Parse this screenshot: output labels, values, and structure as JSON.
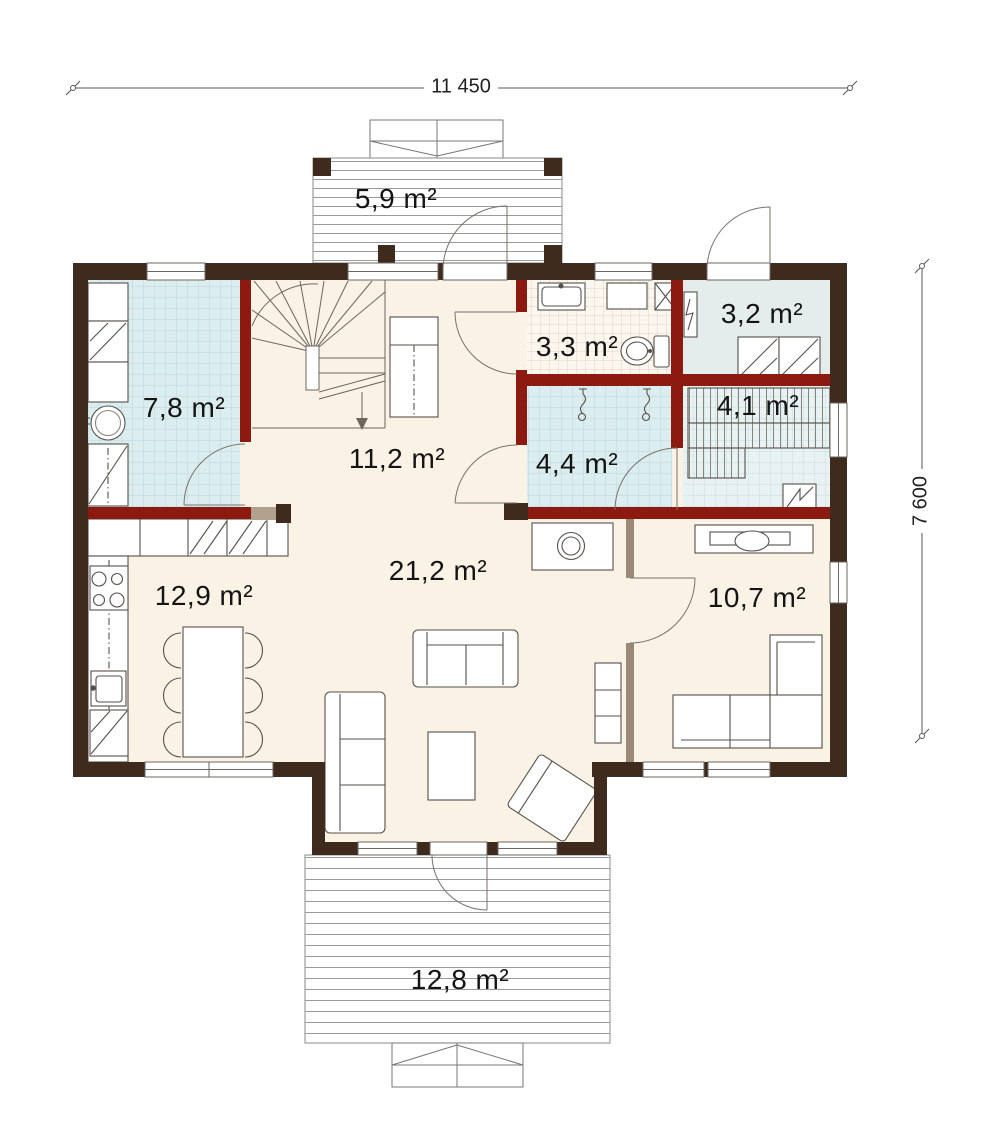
{
  "page": {
    "type": "architectural floor plan",
    "background": "#ffffff"
  },
  "dimensions": {
    "width_label": "11 450",
    "height_label": "7 600"
  },
  "rooms": [
    {
      "id": "entry-porch",
      "label": "5,9 m²"
    },
    {
      "id": "utility-room",
      "label": "7,8 m²"
    },
    {
      "id": "hall",
      "label": "11,2 m²"
    },
    {
      "id": "bathroom",
      "label": "3,3 m²"
    },
    {
      "id": "tech-room",
      "label": "3,2 m²"
    },
    {
      "id": "sauna",
      "label": "4,1 m²"
    },
    {
      "id": "shower-room",
      "label": "4,4 m²"
    },
    {
      "id": "living-room",
      "label": "21,2 m²"
    },
    {
      "id": "kitchen",
      "label": "12,9 m²"
    },
    {
      "id": "bedroom",
      "label": "10,7 m²"
    },
    {
      "id": "terrace",
      "label": "12,8 m²"
    }
  ],
  "colors": {
    "exterior_wall": "#3f2a1e",
    "load_bearing_wall": "#8c1a10",
    "partition_wall": "#9b8977",
    "floor_main": "#fbf2e6",
    "floor_tile_blue": "#dcedf0",
    "tile_grid_blue": "#b7d7db",
    "floor_tile_warm": "#fbf7ef",
    "floor_tech": "#e4edeb",
    "deck_line": "#9a9a9a",
    "furniture_line": "#55504a"
  }
}
